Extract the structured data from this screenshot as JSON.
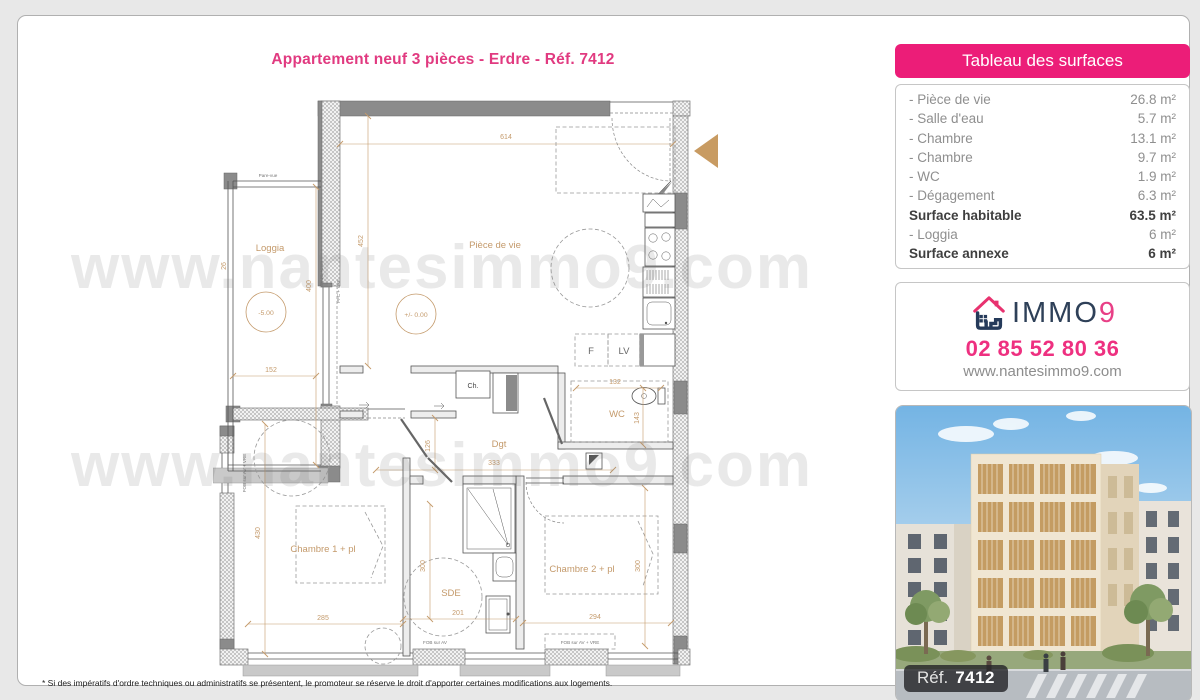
{
  "page": {
    "title": "Appartement neuf 3 pièces - Erdre - Réf. 7412",
    "footnote": "* Si des impératifs d'ordre techniques ou administratifs se présentent, le promoteur se réserve le droit d'apporter certaines modifications aux logements."
  },
  "watermark": {
    "text": "www.nantesimmo9.com"
  },
  "surfaces": {
    "header": "Tableau des surfaces",
    "rows": [
      {
        "label": "- Pièce de vie",
        "value": "26.8 m²"
      },
      {
        "label": "- Salle d'eau",
        "value": "5.7 m²"
      },
      {
        "label": "- Chambre",
        "value": "13.1 m²"
      },
      {
        "label": "- Chambre",
        "value": "9.7 m²"
      },
      {
        "label": "- WC",
        "value": "1.9 m²"
      },
      {
        "label": "- Dégagement",
        "value": "6.3 m²"
      },
      {
        "label": "Surface habitable",
        "value": "63.5 m²"
      },
      {
        "label": "- Loggia",
        "value": "6 m²"
      },
      {
        "label": "Surface annexe",
        "value": "6 m²"
      }
    ]
  },
  "contact": {
    "brand_text": "IMMO",
    "brand_digit": "9",
    "phone": "02 85 52 80 36",
    "website": "www.nantesimmo9.com"
  },
  "photo": {
    "ref_label": "Réf.",
    "ref_value": "7412"
  },
  "plan": {
    "rooms": {
      "living": "Pièce de vie",
      "loggia": "Loggia",
      "wc": "WC",
      "dgt": "Dgt",
      "sde": "SDE",
      "bedroom1": "Chambre 1 + pl",
      "bedroom2": "Chambre 2 + pl",
      "water_heater": "Ch.",
      "fridge": "F",
      "dishwasher": "LV"
    },
    "levels": {
      "loggia": "-5.00",
      "living": "+/- 0.00"
    },
    "dims": {
      "living_w": "614",
      "living_h": "452",
      "loggia_h": "400",
      "loggia_w": "152",
      "loggia_d": "26",
      "wc_w": "132",
      "wc_h": "143",
      "dgt_h": "126",
      "dgt_w": "333",
      "bed1_h": "430",
      "bed1_w": "285",
      "sde_h": "300",
      "sde_w": "201",
      "bed2_w": "294",
      "bed2_h": "300"
    },
    "annotations": {
      "pare_vue": "Pare-vue",
      "seuil": "SEUIL +2cm",
      "pfc_vre": "PFC + VRE",
      "fob_left": "FOB sur AV + VRE",
      "fob_sde": "FOB sur AV",
      "fob_bed2": "FOB sur AV + VRE"
    }
  },
  "colors": {
    "accent_pink": "#ec1d78",
    "title_pink": "#e13a80",
    "brand_navy": "#2e4058",
    "plan_tan": "#c49a6b",
    "wall_gray": "#8b8b8b"
  }
}
